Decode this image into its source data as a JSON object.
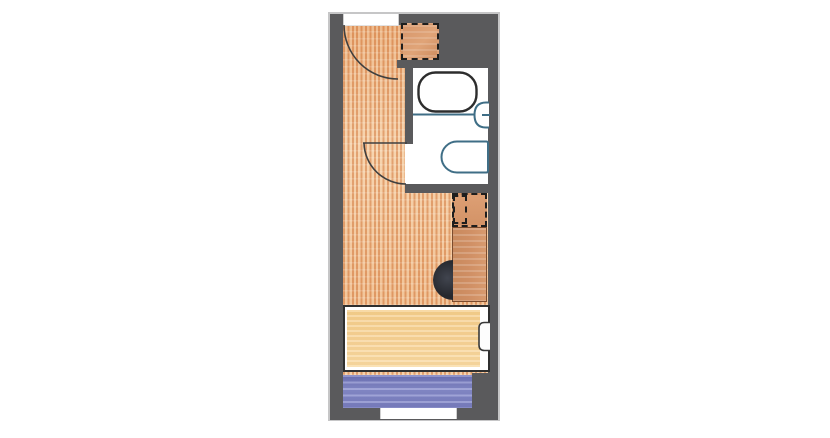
{
  "canvas": {
    "width": 830,
    "height": 438,
    "background": "#ffffff"
  },
  "floorplan": {
    "kind": "studio room floor plan",
    "orientation": "vertical",
    "rooms": [
      {
        "name": "entry",
        "floor": "wood planks"
      },
      {
        "name": "bathroom",
        "floor": "white"
      },
      {
        "name": "main-room",
        "floor": "wood planks"
      }
    ],
    "openings": [
      {
        "name": "entrance-door",
        "type": "hinged-door-with-swing-arc",
        "wall": "top"
      },
      {
        "name": "bathroom-door",
        "type": "hinged-door-with-swing-arc",
        "wall": "bathroom-left"
      },
      {
        "name": "window",
        "type": "wall-opening",
        "wall": "bottom"
      }
    ],
    "fixtures": [
      {
        "name": "shoe-cabinet",
        "style": "dashed outline, wood fill"
      },
      {
        "name": "bathtub",
        "style": "rounded rectangle outline"
      },
      {
        "name": "washbasin",
        "style": "half-round on right wall with faucet tick"
      },
      {
        "name": "toilet",
        "style": "bullet shape outline"
      },
      {
        "name": "overhead-shelf",
        "style": "dashed outline above desk"
      },
      {
        "name": "desk",
        "style": "solid wood fill"
      },
      {
        "name": "desk-chair",
        "style": "black half-disk"
      },
      {
        "name": "bed",
        "style": "outlined frame with yellow mattress"
      },
      {
        "name": "pillow",
        "style": "rounded outline at bed head"
      },
      {
        "name": "rug",
        "style": "blue watercolor"
      }
    ]
  },
  "colors": {
    "canvas-bg": "#ffffff",
    "wall": "#5a5a5c",
    "wall-outline": "#c6c6c7",
    "floor-stripe": "#df9a66",
    "floor-base": "#f6d2ab",
    "wood": "#d6966b",
    "desk": "#cf8e63",
    "bed": "#f7d193",
    "rug": "#7b80c4",
    "chair": "#26282e",
    "fixture-line": "#3f6e86",
    "tub-line": "#2d2d2d",
    "door-arc": "#3f3f3f"
  }
}
